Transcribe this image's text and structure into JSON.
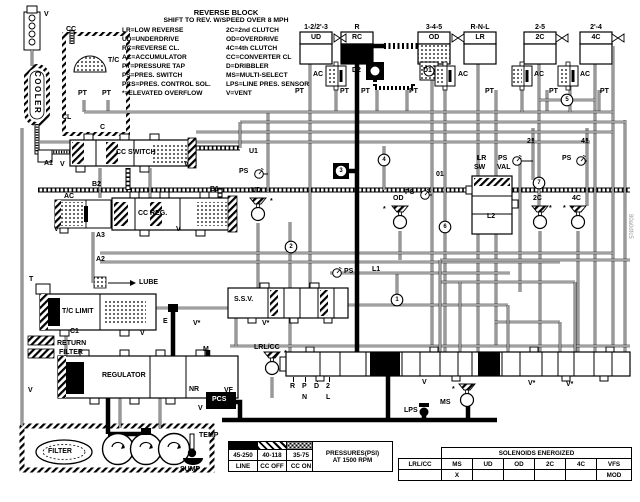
{
  "legend": {
    "title": "REVERSE BLOCK",
    "subtitle": "SHIFT TO REV. W/SPEED OVER 8 MPH",
    "abbreviations": [
      [
        "LR=LOW REVERSE",
        "2C=2nd CLUTCH"
      ],
      [
        "UD=UNDERDRIVE",
        "OD=OVERDRIVE"
      ],
      [
        "RC=REVERSE CL.",
        "4C=4th CLUTCH"
      ],
      [
        "AC=ACCUMULATOR",
        "CC=CONVERTER CL"
      ],
      [
        "PT=PRESSURE TAP",
        "D=DRIBBLER"
      ],
      [
        "PS=PRES. SWITCH",
        "MS=MULTI-SELECT"
      ],
      [
        "PCS=PRES. CONTROL SOL.",
        "LPS=LINE PRES. SENSOR"
      ],
      [
        "*=ELEVATED OVERFLOW",
        "V=VENT"
      ]
    ]
  },
  "clutches": [
    {
      "gear": "1-2/2'-3",
      "name": "UD",
      "fill": "white",
      "x": 300
    },
    {
      "gear": "R",
      "name": "RC",
      "fill": "black",
      "x": 341
    },
    {
      "gear": "3-4-5",
      "name": "OD",
      "fill": "dots",
      "x": 418
    },
    {
      "gear": "R-N-L",
      "name": "LR",
      "fill": "white",
      "x": 464
    },
    {
      "gear": "2-5",
      "name": "2C",
      "fill": "white",
      "x": 524
    },
    {
      "gear": "2'-4",
      "name": "4C",
      "fill": "white",
      "x": 580
    }
  ],
  "circled_numbers": [
    {
      "t": "1",
      "x": 397,
      "y": 300
    },
    {
      "t": "2",
      "x": 291,
      "y": 247
    },
    {
      "t": "3",
      "x": 341,
      "y": 171,
      "sq": true
    },
    {
      "t": "4",
      "x": 384,
      "y": 160
    },
    {
      "t": "5",
      "x": 567,
      "y": 100
    },
    {
      "t": "6",
      "x": 445,
      "y": 227
    },
    {
      "t": "7",
      "x": 539,
      "y": 183
    }
  ],
  "labels": [
    {
      "n": "vent-top",
      "t": "V",
      "x": 44,
      "y": 11
    },
    {
      "n": "cc-top",
      "t": "CC",
      "x": 66,
      "y": 26
    },
    {
      "n": "torque-converter",
      "t": "T/C",
      "x": 108,
      "y": 57
    },
    {
      "n": "pt-tc-left",
      "t": "PT",
      "x": 78,
      "y": 90
    },
    {
      "n": "pt-tc-right",
      "t": "PT",
      "x": 102,
      "y": 90
    },
    {
      "n": "cooler",
      "t": "COOLER",
      "x": 41,
      "y": 71,
      "c": "rot"
    },
    {
      "n": "cl-port",
      "t": "CL",
      "x": 62,
      "y": 114
    },
    {
      "n": "c-port",
      "t": "C",
      "x": 100,
      "y": 124
    },
    {
      "n": "cc-switch-valve",
      "t": "CC SWITCH",
      "x": 116,
      "y": 149
    },
    {
      "n": "a1-port",
      "t": "A1",
      "x": 44,
      "y": 160
    },
    {
      "n": "v-ccswitch-left",
      "t": "V",
      "x": 60,
      "y": 161
    },
    {
      "n": "v-ccswitch-right",
      "t": "V",
      "x": 184,
      "y": 161
    },
    {
      "n": "b2-port",
      "t": "B2",
      "x": 92,
      "y": 181
    },
    {
      "n": "b1-port",
      "t": "B1",
      "x": 210,
      "y": 186
    },
    {
      "n": "ac-ccreg",
      "t": "AC",
      "x": 64,
      "y": 193
    },
    {
      "n": "cc-reg-valve",
      "t": "CC REG.",
      "x": 138,
      "y": 210
    },
    {
      "n": "v-accum",
      "t": "V",
      "x": 54,
      "y": 226
    },
    {
      "n": "v-ccreg",
      "t": "V",
      "x": 176,
      "y": 226
    },
    {
      "n": "a3-port",
      "t": "A3",
      "x": 96,
      "y": 232
    },
    {
      "n": "a2-port",
      "t": "A2",
      "x": 96,
      "y": 256
    },
    {
      "n": "t-port",
      "t": "T",
      "x": 29,
      "y": 276
    },
    {
      "n": "lube-port",
      "t": "LUBE",
      "x": 139,
      "y": 279
    },
    {
      "n": "tc-limit-valve",
      "t": "T/C LIMIT",
      "x": 62,
      "y": 308
    },
    {
      "n": "v-tclimit",
      "t": "V",
      "x": 140,
      "y": 330
    },
    {
      "n": "c1-port",
      "t": "C1",
      "x": 70,
      "y": 328
    },
    {
      "n": "return-filter-line1",
      "t": "RETURN",
      "x": 57,
      "y": 340
    },
    {
      "n": "return-filter-line2",
      "t": "FILTER",
      "x": 59,
      "y": 349
    },
    {
      "n": "regulator-valve",
      "t": "REGULATOR",
      "x": 102,
      "y": 372
    },
    {
      "n": "v-regulator",
      "t": "V",
      "x": 28,
      "y": 387
    },
    {
      "n": "e-port",
      "t": "E",
      "x": 163,
      "y": 318
    },
    {
      "n": "v-star-ssv-1",
      "t": "V*",
      "x": 193,
      "y": 320
    },
    {
      "n": "ssv-valve",
      "t": "S.S.V.",
      "x": 234,
      "y": 296
    },
    {
      "n": "v-star-ssv-2",
      "t": "V*",
      "x": 262,
      "y": 320
    },
    {
      "n": "m-port",
      "t": "M",
      "x": 203,
      "y": 346
    },
    {
      "n": "nr-valve",
      "t": "NR",
      "x": 189,
      "y": 386
    },
    {
      "n": "vf-port",
      "t": "VF",
      "x": 224,
      "y": 387
    },
    {
      "n": "pcs-solenoid",
      "t": "PCS",
      "x": 212,
      "y": 396,
      "c": "w"
    },
    {
      "n": "v-pcs",
      "t": "V",
      "x": 198,
      "y": 405
    },
    {
      "n": "lr-cc-solenoid",
      "t": "LRL/CC",
      "x": 254,
      "y": 344
    },
    {
      "n": "star-lrcc",
      "t": "*",
      "x": 284,
      "y": 350
    },
    {
      "n": "filter",
      "t": "FILTER",
      "x": 48,
      "y": 448
    },
    {
      "n": "temp-sensor",
      "t": "TEMP",
      "x": 199,
      "y": 432
    },
    {
      "n": "sump",
      "t": "SUMP",
      "x": 180,
      "y": 466
    },
    {
      "n": "u1-line",
      "t": "U1",
      "x": 249,
      "y": 148
    },
    {
      "n": "ps-ud",
      "t": "PS",
      "x": 239,
      "y": 168
    },
    {
      "n": "ud-solenoid",
      "t": "UD",
      "x": 251,
      "y": 187
    },
    {
      "n": "star-ud",
      "t": "*",
      "x": 270,
      "y": 198
    },
    {
      "n": "ps-od",
      "t": "PS",
      "x": 405,
      "y": 189
    },
    {
      "n": "line-01",
      "t": "01",
      "x": 436,
      "y": 171
    },
    {
      "n": "ps-l1",
      "t": "PS",
      "x": 344,
      "y": 268
    },
    {
      "n": "l1-line",
      "t": "L1",
      "x": 372,
      "y": 266
    },
    {
      "n": "od-solenoid",
      "t": "OD",
      "x": 393,
      "y": 195
    },
    {
      "n": "star-od",
      "t": "*",
      "x": 383,
      "y": 206
    },
    {
      "n": "lr-sw-label1",
      "t": "LR",
      "x": 477,
      "y": 155
    },
    {
      "n": "lr-sw-label2",
      "t": "SW",
      "x": 474,
      "y": 164
    },
    {
      "n": "lr-sw-label3",
      "t": "VAL",
      "x": 497,
      "y": 164
    },
    {
      "n": "l2-line",
      "t": "L2",
      "x": 487,
      "y": 213
    },
    {
      "n": "ps-21",
      "t": "PS",
      "x": 498,
      "y": 155
    },
    {
      "n": "line-21",
      "t": "21",
      "x": 527,
      "y": 138
    },
    {
      "n": "2c-solenoid",
      "t": "2C",
      "x": 533,
      "y": 195
    },
    {
      "n": "star-2c",
      "t": "*",
      "x": 549,
      "y": 205
    },
    {
      "n": "ps-41",
      "t": "PS",
      "x": 562,
      "y": 155
    },
    {
      "n": "line-41",
      "t": "41",
      "x": 581,
      "y": 138
    },
    {
      "n": "4c-solenoid",
      "t": "4C",
      "x": 572,
      "y": 195
    },
    {
      "n": "star-4c",
      "t": "*",
      "x": 563,
      "y": 205
    },
    {
      "n": "v-manual",
      "t": "V",
      "x": 422,
      "y": 379
    },
    {
      "n": "v-star-right-1",
      "t": "V*",
      "x": 528,
      "y": 380
    },
    {
      "n": "v-star-right-2",
      "t": "V*",
      "x": 566,
      "y": 381
    },
    {
      "n": "lps-sensor",
      "t": "LPS",
      "x": 404,
      "y": 407
    },
    {
      "n": "ms-solenoid",
      "t": "MS",
      "x": 440,
      "y": 399
    },
    {
      "n": "star-ms",
      "t": "*",
      "x": 452,
      "y": 386
    },
    {
      "n": "manual-r",
      "t": "R",
      "x": 290,
      "y": 383
    },
    {
      "n": "manual-p",
      "t": "P",
      "x": 302,
      "y": 383
    },
    {
      "n": "manual-d",
      "t": "D",
      "x": 314,
      "y": 383
    },
    {
      "n": "manual-2",
      "t": "2",
      "x": 326,
      "y": 383
    },
    {
      "n": "manual-n",
      "t": "N",
      "x": 302,
      "y": 394
    },
    {
      "n": "manual-l",
      "t": "L",
      "x": 326,
      "y": 394
    },
    {
      "n": "d2-dribbler",
      "t": "D2",
      "x": 352,
      "y": 67
    },
    {
      "n": "d1-dribbler",
      "t": "D1",
      "x": 423,
      "y": 67
    },
    {
      "n": "ac-ud",
      "t": "AC",
      "x": 313,
      "y": 71
    },
    {
      "n": "ac-od",
      "t": "AC",
      "x": 458,
      "y": 71
    },
    {
      "n": "ac-lr",
      "t": "AC",
      "x": 534,
      "y": 71
    },
    {
      "n": "ac-4c",
      "t": "AC",
      "x": 580,
      "y": 71
    },
    {
      "n": "pt-ud",
      "t": "PT",
      "x": 295,
      "y": 88
    },
    {
      "n": "pt-ud-ac",
      "t": "PT",
      "x": 340,
      "y": 88
    },
    {
      "n": "pt-rc",
      "t": "PT",
      "x": 361,
      "y": 88
    },
    {
      "n": "pt-od",
      "t": "PT",
      "x": 409,
      "y": 88
    },
    {
      "n": "pt-lr",
      "t": "PT",
      "x": 485,
      "y": 88
    },
    {
      "n": "pt-2c",
      "t": "PT",
      "x": 549,
      "y": 88
    },
    {
      "n": "pt-4c",
      "t": "PT",
      "x": 600,
      "y": 88
    }
  ],
  "pressure_table": {
    "values": [
      "45-250",
      "40-118",
      "35-75"
    ],
    "modes": [
      "LINE",
      "CC OFF",
      "CC ON"
    ],
    "note_line1": "PRESSURES(PSI)",
    "note_line2": "AT 1500 RPM"
  },
  "solenoid_table": {
    "title": "SOLENOIDS ENERGIZED",
    "columns": [
      "LRL/CC",
      "MS",
      "UD",
      "OD",
      "2C",
      "4C",
      "VFS"
    ],
    "energized": [
      "",
      "X",
      "",
      "",
      "",
      "",
      "MOD"
    ]
  },
  "watermark": "80a0dfc5"
}
